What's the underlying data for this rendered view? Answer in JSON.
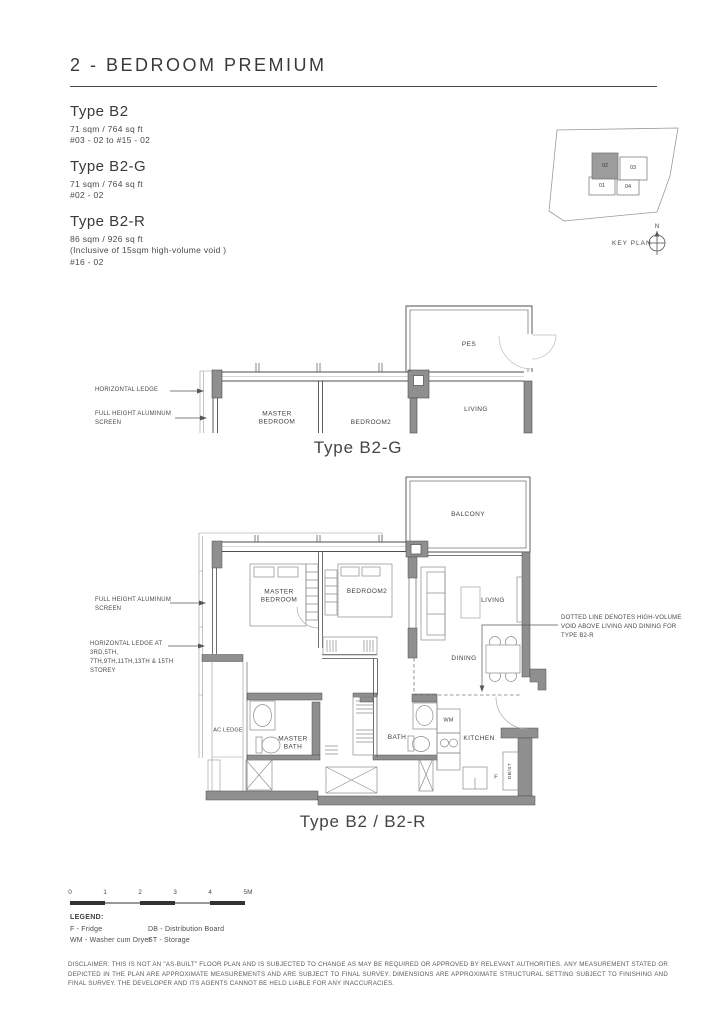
{
  "page": {
    "title": "2 - BEDROOM PREMIUM"
  },
  "unit_types": [
    {
      "name": "Type B2",
      "area": "71 sqm / 764 sq ft",
      "levels": "#03 - 02 to #15 - 02"
    },
    {
      "name": "Type B2-G",
      "area": "71 sqm / 764 sq ft",
      "levels": "#02 - 02"
    },
    {
      "name": "Type B2-R",
      "area": "86 sqm / 926 sq ft",
      "note": "(Inclusive of 15sqm high-volume void )",
      "levels": "#16 - 02"
    }
  ],
  "key_plan": {
    "label": "KEY PLAN",
    "north": "N",
    "units": [
      "01",
      "02",
      "03",
      "04"
    ],
    "highlighted_unit": "02"
  },
  "plan_b2g": {
    "caption": "Type B2-G",
    "rooms": {
      "pes": "PES",
      "master_bedroom": "MASTER BEDROOM",
      "bedroom2": "BEDROOM2",
      "living": "LIVING"
    },
    "annotations": {
      "horizontal_ledge": "HORIZONTAL LEDGE",
      "full_height_screen": "FULL HEIGHT ALUMINUM SCREEN"
    }
  },
  "plan_b2": {
    "caption": "Type B2 / B2-R",
    "rooms": {
      "balcony": "BALCONY",
      "master_bedroom": "MASTER BEDROOM",
      "bedroom2": "BEDROOM2",
      "living": "LIVING",
      "dining": "DINING",
      "kitchen": "KITCHEN",
      "bath": "BATH",
      "master_bath": "MASTER BATH",
      "ac_ledge": "AC LEDGE",
      "wm": "WM",
      "fridge": "F",
      "db_st": "DB/ST"
    },
    "annotations": {
      "full_height_screen": "FULL HEIGHT ALUMINUM SCREEN",
      "horizontal_ledge_storeys": "HORIZONTAL LEDGE AT 3RD,5TH, 7TH,9TH,11TH,13TH & 15TH STOREY",
      "void_note": "DOTTED LINE DENOTES HIGH-VOLUME VOID ABOVE LIVING AND DINING FOR TYPE B2-R"
    }
  },
  "scale_bar": {
    "ticks": [
      "0",
      "1",
      "2",
      "3",
      "4"
    ],
    "end_label": "5M"
  },
  "legend": {
    "title": "LEGEND:",
    "columns": [
      [
        "F - Fridge",
        "WM - Washer cum Dryer"
      ],
      [
        "DB - Distribution Board",
        "ST - Storage"
      ]
    ]
  },
  "disclaimer": "DISCLAIMER: THIS IS NOT AN \"AS-BUILT\" FLOOR PLAN AND IS SUBJECTED TO CHANGE AS MAY BE REQUIRED OR APPROVED BY RELEVANT AUTHORITIES. ANY MEASUREMENT STATED OR DEPICTED IN THE PLAN ARE APPROXIMATE MEASUREMENTS AND ARE SUBJECT TO FINAL SURVEY. DIMENSIONS ARE APPROXIMATE STRUCTURAL SETTING SUBJECT TO FINISHING AND FINAL SURVEY. THE DEVELOPER AND ITS AGENTS CANNOT BE HELD LIABLE FOR ANY INACCURACIES.",
  "colors": {
    "wall_fill": "#8f8f8f",
    "line": "#4e4e4e",
    "text": "#3d3d3d",
    "highlight_unit_fill": "#9c9c9c"
  }
}
